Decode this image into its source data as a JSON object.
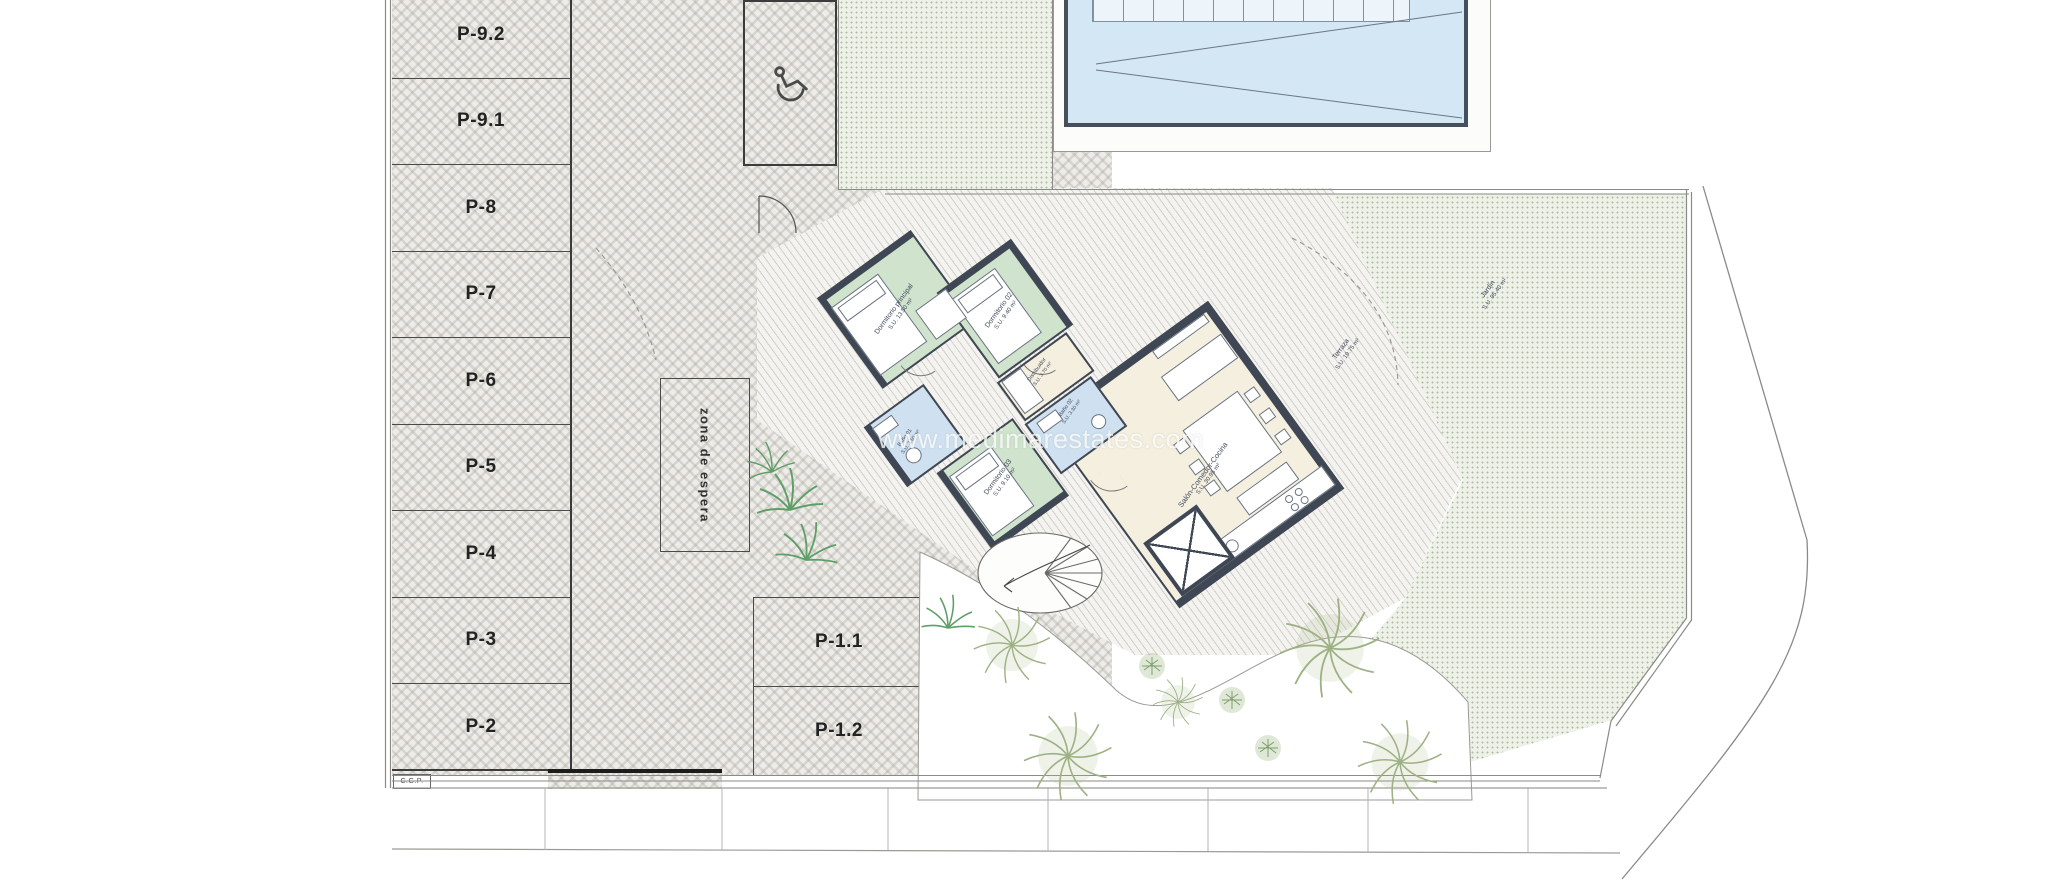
{
  "watermark": {
    "text": "www.medimarestates.com"
  },
  "parking": {
    "column_stalls": [
      "P-9.2",
      "P-9.1",
      "P-8",
      "P-7",
      "P-6",
      "P-5",
      "P-4",
      "P-3",
      "P-2"
    ],
    "island_stalls": [
      "P-1.1",
      "P-1.2"
    ],
    "waiting_zone_label": "zona de espera",
    "utility_box_label": "C.G.P."
  },
  "house": {
    "rooms": [
      {
        "id": "dormitorio-principal",
        "label": "Dormitorio principal",
        "area": "S.U. 13.50 m²"
      },
      {
        "id": "dormitorio-02",
        "label": "Dormitorio 02",
        "area": "S.U. 9.40 m²"
      },
      {
        "id": "dormitorio-03",
        "label": "Dormitorio 03",
        "area": "S.U. 9.10 m²"
      },
      {
        "id": "bano-01",
        "label": "Baño 01",
        "area": "S.U. 3.50 m²"
      },
      {
        "id": "bano-02",
        "label": "Baño 02",
        "area": "S.U. 3.30 m²"
      },
      {
        "id": "distribuidor",
        "label": "Distribuidor",
        "area": "S.U. 3.70 m²"
      },
      {
        "id": "salon-comedor-cocina",
        "label": "Salón-Comedor-Cocina",
        "area": "S.U. 30.95 m²"
      }
    ]
  },
  "outdoor": {
    "labels": [
      {
        "id": "terraza",
        "label": "Terraza",
        "area": "S.U. 19.75 m²"
      },
      {
        "id": "jardin",
        "label": "Jardín",
        "area": "S.U. 95.40 m²"
      }
    ]
  },
  "icons": {
    "accessible_parking": "wheelchair-icon"
  },
  "colors": {
    "bedroom_green": "#cfe3cd",
    "bath_blue": "#cfe1f0",
    "living_cream": "#f5efdf",
    "wall_dark": "#3f4754",
    "pool_blue": "#d3e7f5",
    "plant_green": "#8fae77",
    "paving_grey": "#edece8"
  }
}
